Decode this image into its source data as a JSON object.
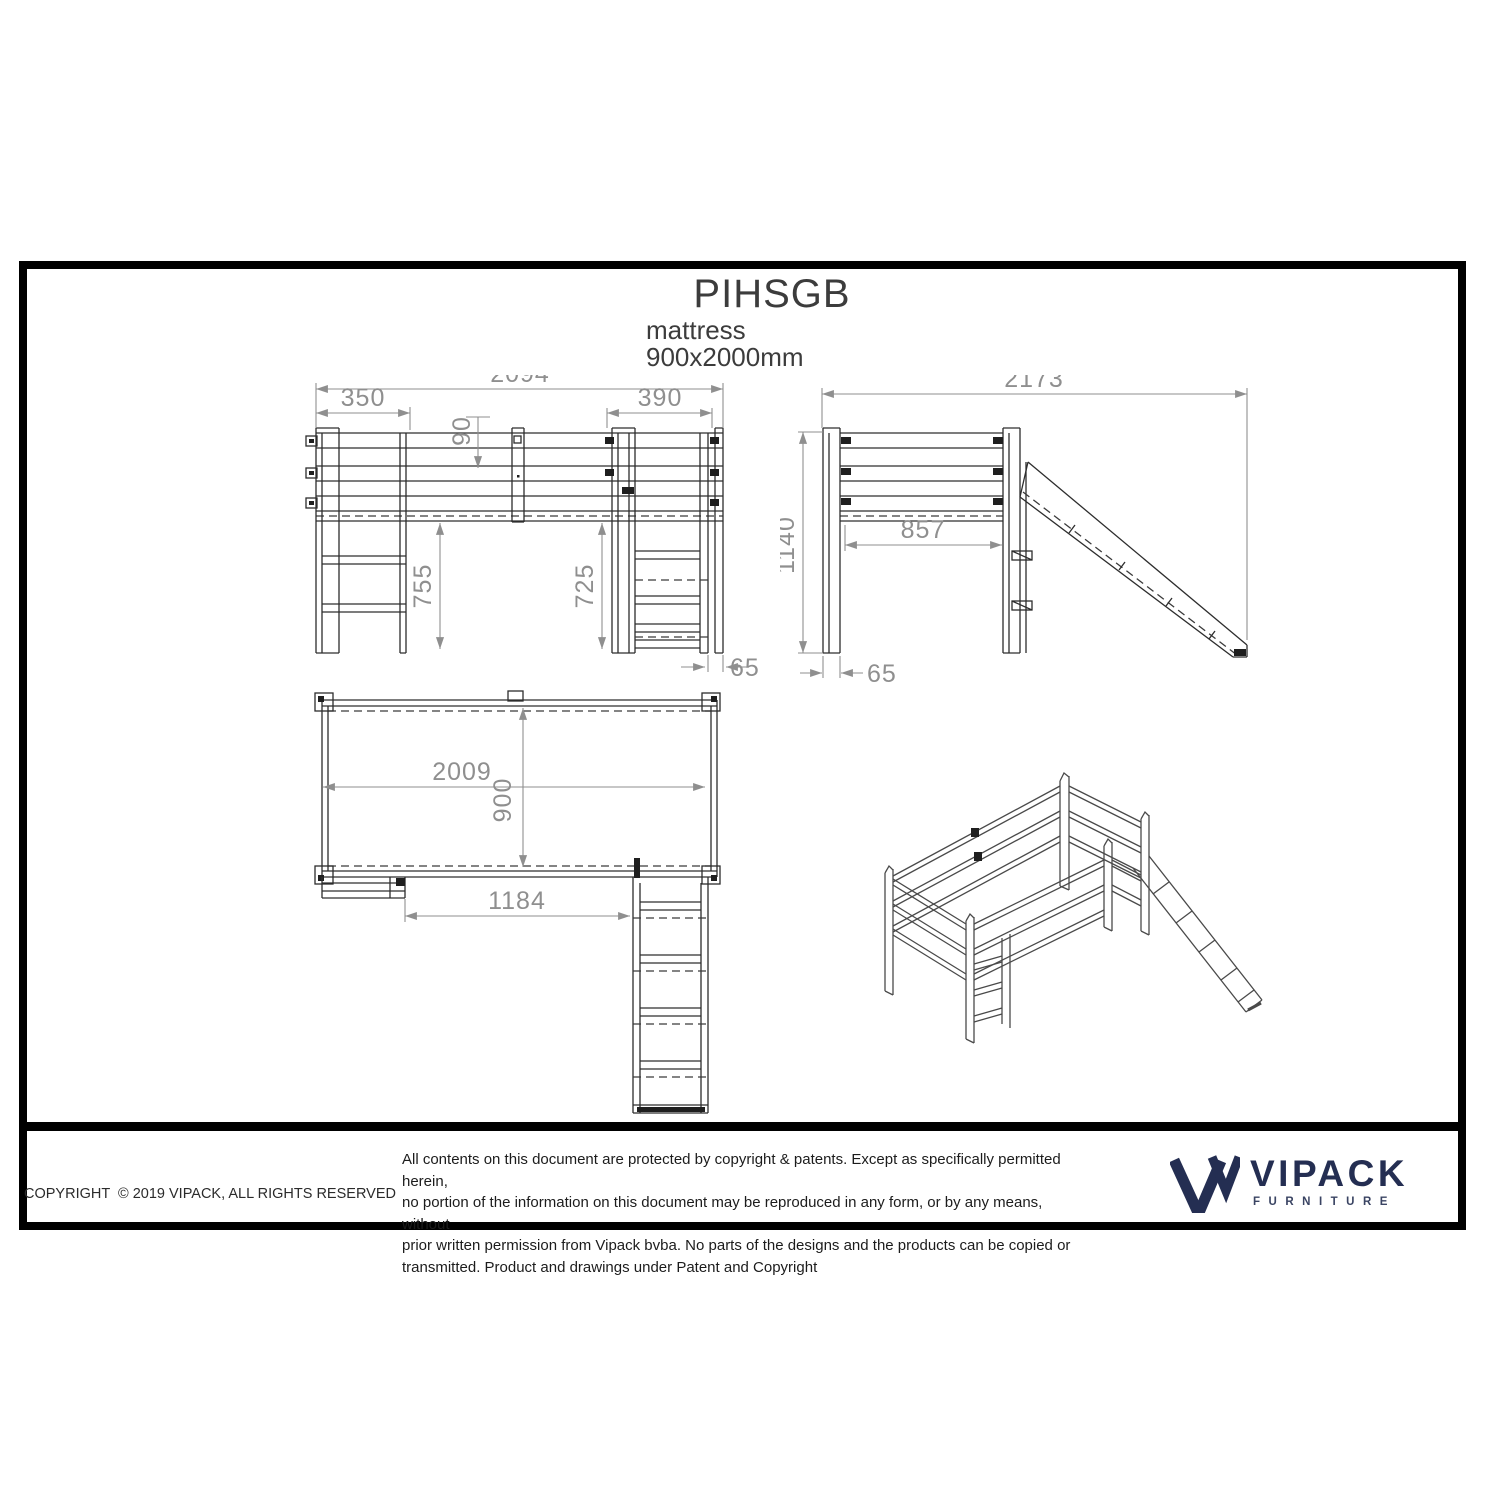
{
  "title_block": {
    "product_code": "PIHSGB",
    "mattress_label": "mattress",
    "mattress_size": "900x2000mm"
  },
  "dims": {
    "front_overall_width": "2094",
    "front_left_section": "350",
    "front_rail_height": "90",
    "front_right_section": "390",
    "front_clearance_left": "755",
    "front_clearance_right": "725",
    "front_post_width": "65",
    "side_overall_depth": "2173",
    "side_overall_height": "1140",
    "side_inner_width": "857",
    "side_post_width": "65",
    "plan_inner_length": "2009",
    "plan_inner_width": "900",
    "plan_ladder_offset": "1184"
  },
  "footer": {
    "copyright": "COPYRIGHT  © 2019 VIPACK, ALL RIGHTS RESERVED",
    "legal_lines": [
      "All contents on this document are protected by copyright & patents. Except as specifically permitted herein,",
      "no portion of the information on this document may be reproduced in any form, or by any means, without",
      "prior written permission from Vipack bvba. No parts of the designs and the products can be copied or",
      "transmitted. Product and drawings under Patent and Copyright"
    ],
    "brand_name": "VIPACK",
    "brand_tagline": "FURNITURE"
  },
  "palette": {
    "frame_border": "#000000",
    "drawing_line": "#2d2d2d",
    "dimension_gray": "#8f8f8f",
    "logo_navy": "#242e52"
  }
}
